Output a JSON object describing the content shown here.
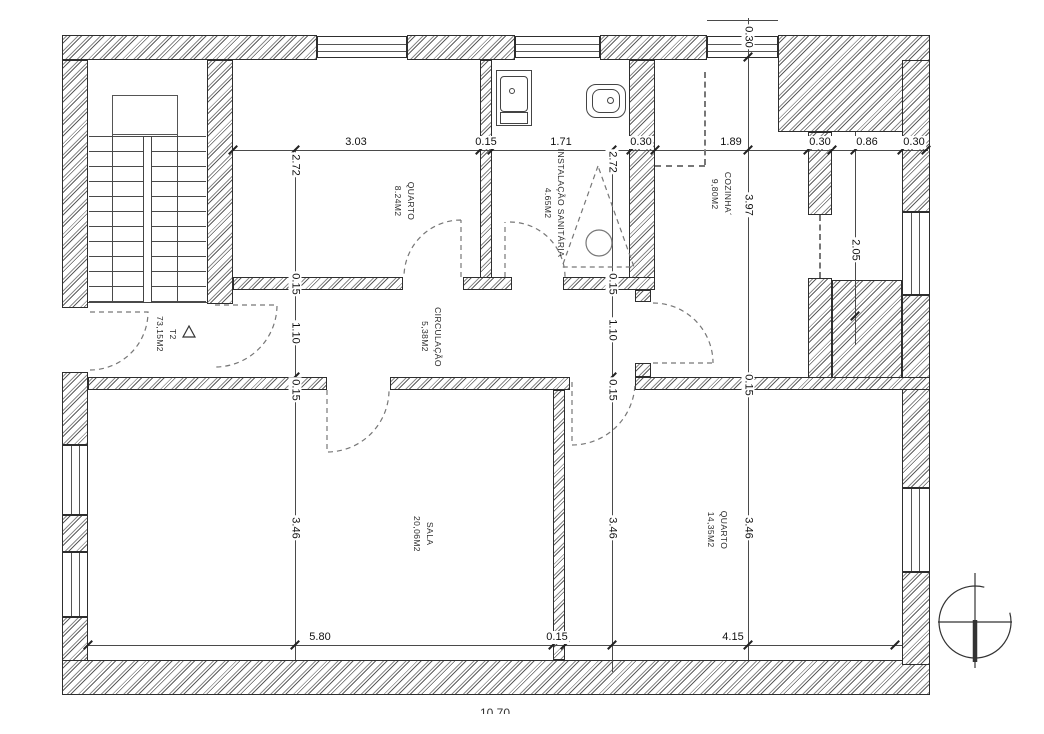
{
  "rooms": [
    {
      "name": "QUARTO",
      "area": "8.24M2"
    },
    {
      "name": "INSTALAÇÃO SANITÁRIA",
      "area": "4.65M2"
    },
    {
      "name": "COZINHA´",
      "area": "9,80M2"
    },
    {
      "name": "T2",
      "area": "73,15M2"
    },
    {
      "name": "CIRCULAÇÃO",
      "area": "5,38M2"
    },
    {
      "name": "SALA",
      "area": "20,06M2"
    },
    {
      "name": "QUARTO",
      "area": "14,35M2"
    }
  ],
  "dims": {
    "top": [
      "3.03",
      "0.15",
      "1.71",
      "0.30",
      "1.89",
      "0.30",
      "0.86",
      "0.30"
    ],
    "left": [
      "2.72",
      "0.15",
      "1.10",
      "0.15",
      "3.46"
    ],
    "mid": [
      "2.72",
      "0.15",
      "1.10",
      "0.15",
      "3.46"
    ],
    "right": [
      "0.30",
      "3.97",
      "0.15",
      "3.46"
    ],
    "balcony": [
      "2.05"
    ],
    "bottom": [
      "5.80",
      "0.15",
      "4.15"
    ],
    "overall": "10.70"
  }
}
